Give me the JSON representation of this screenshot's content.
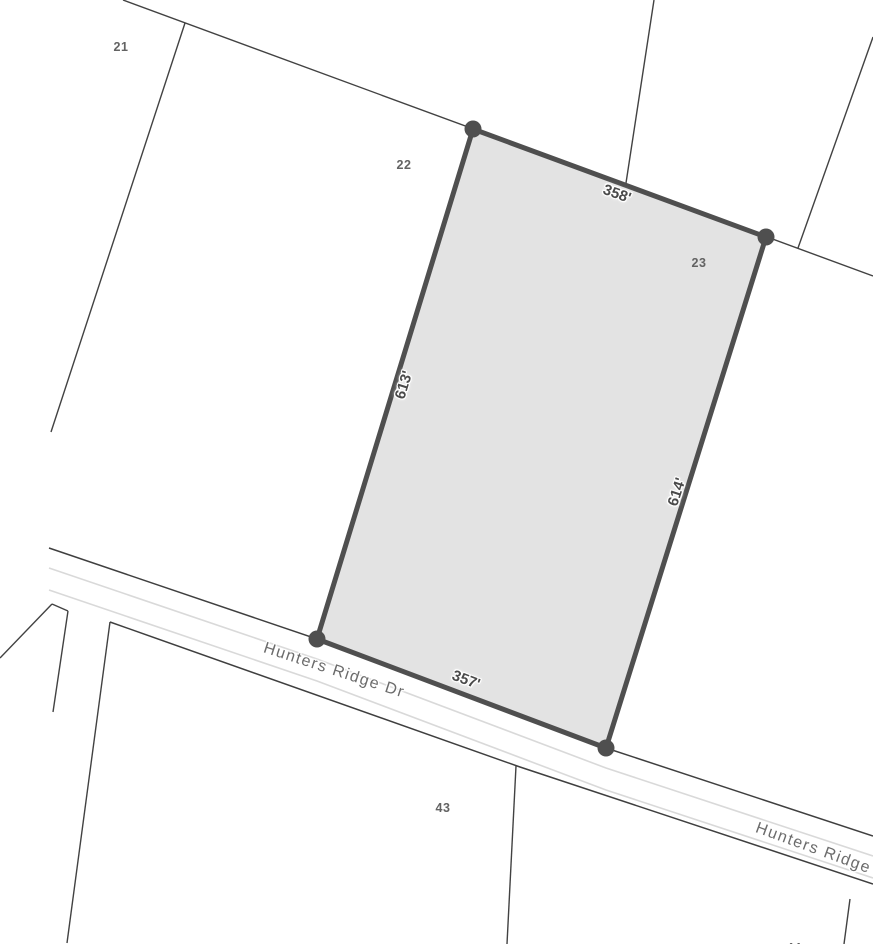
{
  "map": {
    "selected_parcel": {
      "lot_number": "23",
      "edge_lengths": {
        "top": "358'",
        "left": "613'",
        "right": "614'",
        "bottom": "357'"
      }
    },
    "lot_numbers": {
      "lot_21": "21",
      "lot_22": "22",
      "lot_23": "23",
      "lot_43": "43",
      "lot_44_partial": "44"
    },
    "streets": {
      "hunters_ridge_dr": "Hunters Ridge Dr",
      "hunters_ridge_dr_east_clipped": "Hunters Ridge Dr"
    },
    "colors": {
      "background": "#ffffff",
      "parcel_fill": "#e3e3e3",
      "selection_outline": "#4f4f4f",
      "boundary_line": "#424242",
      "road_edge": "#3f3f3f",
      "lane_marking": "#d9d9d9",
      "dimension_text": "#4a4a4a",
      "lot_number_text": "#636363",
      "street_name_text": "#6b6b6b"
    }
  }
}
